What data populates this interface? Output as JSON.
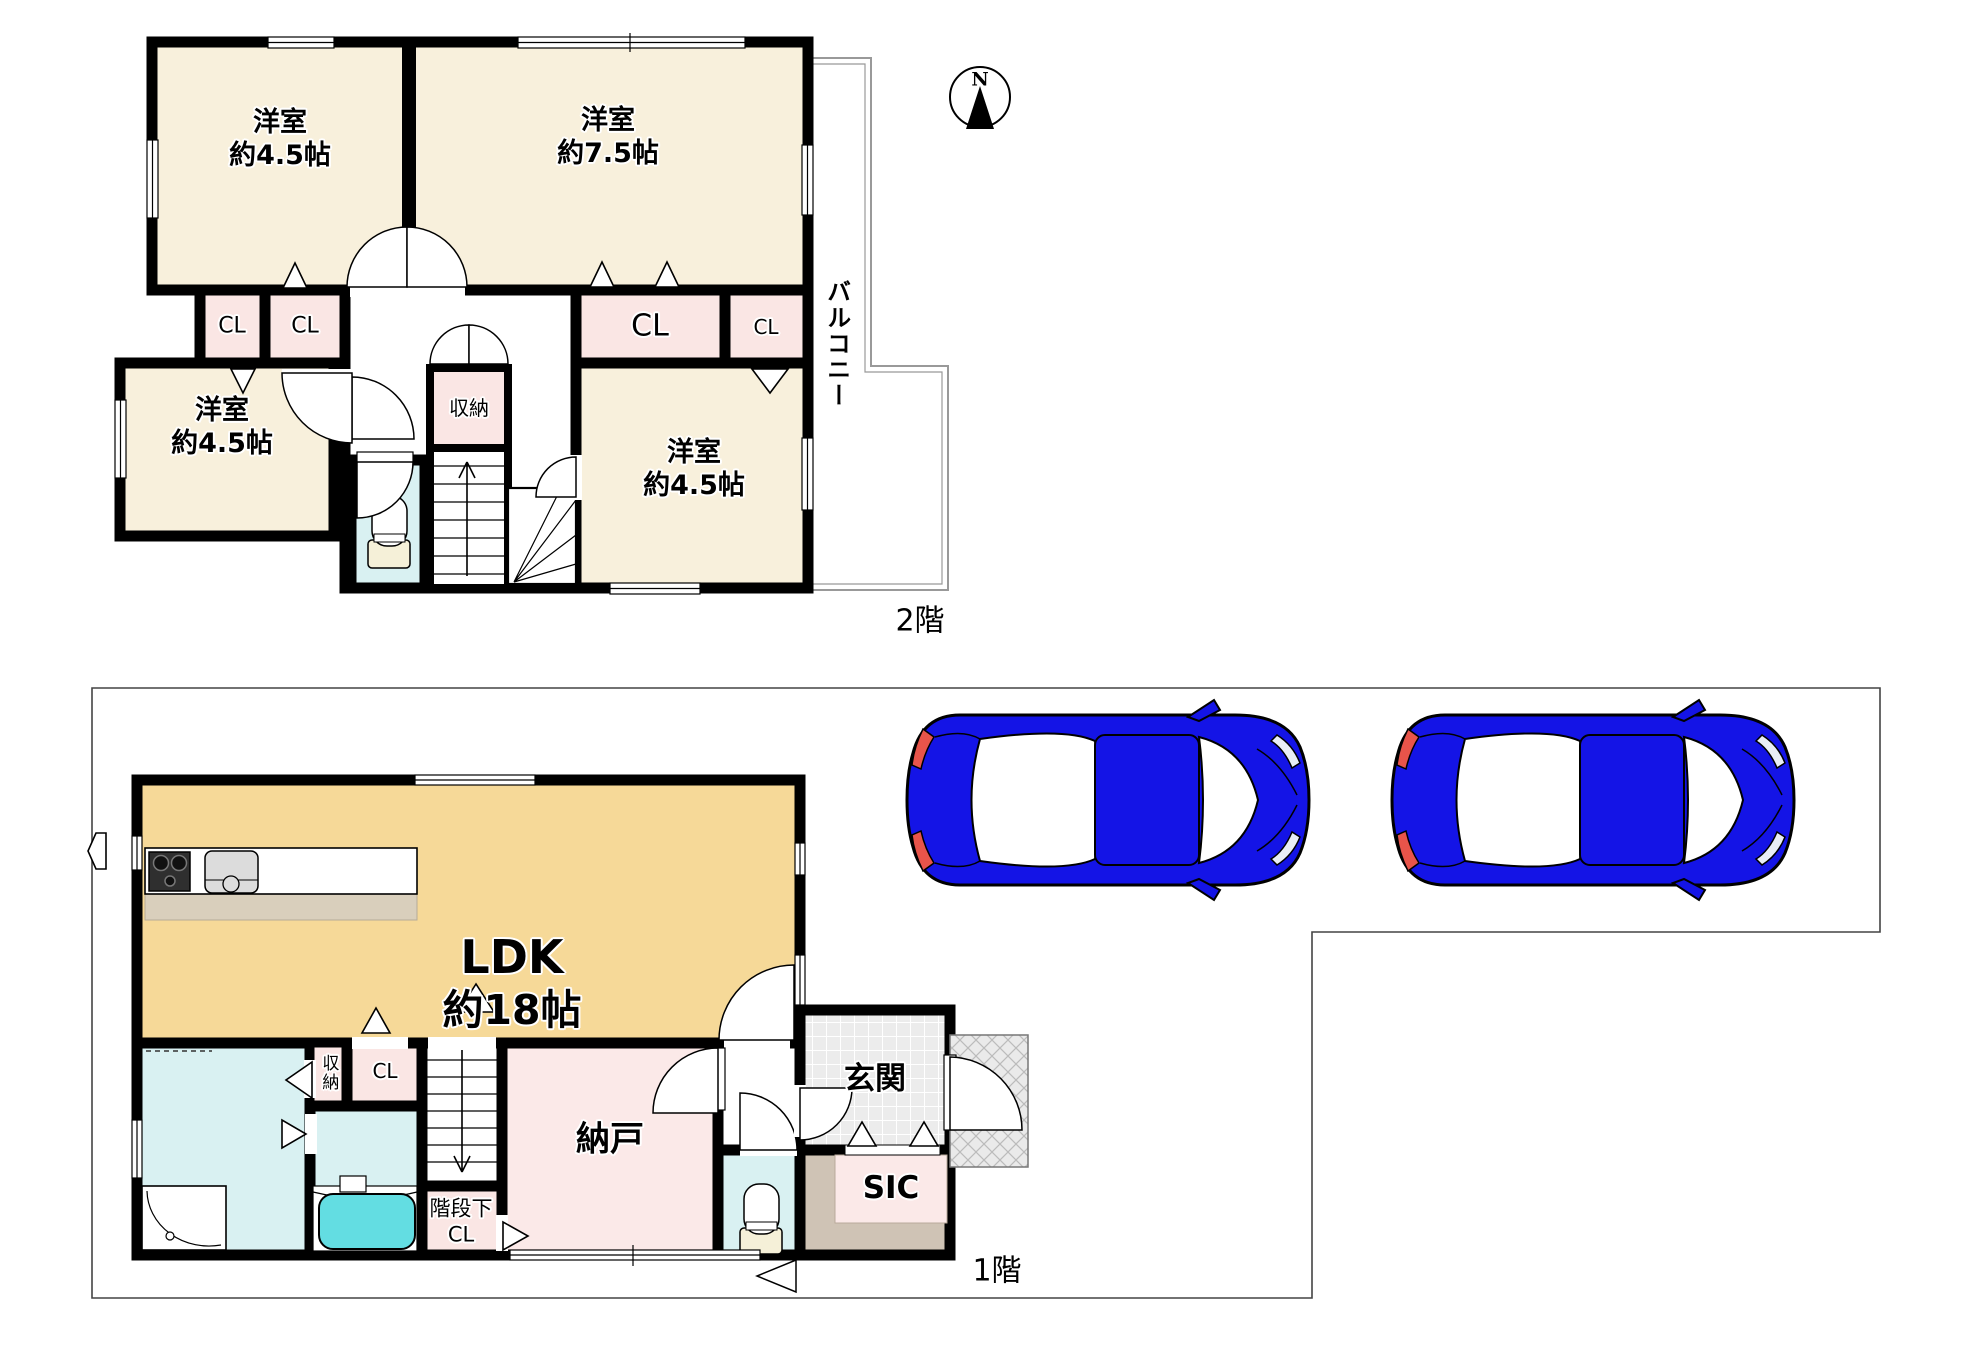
{
  "floor2": {
    "label": "2階",
    "compass_n": "N",
    "rooms": {
      "room_tl": {
        "name": "洋室",
        "size": "約4.5帖"
      },
      "room_tr": {
        "name": "洋室",
        "size": "約7.5帖"
      },
      "room_bl": {
        "name": "洋室",
        "size": "約4.5帖"
      },
      "room_br": {
        "name": "洋室",
        "size": "約4.5帖"
      },
      "cl_a": "CL",
      "cl_b": "CL",
      "cl_big": "CL",
      "cl_small": "CL",
      "shuno": "収納",
      "balcony": "バルコニー"
    }
  },
  "floor1": {
    "label": "1階",
    "rooms": {
      "ldk": {
        "name": "LDK",
        "size": "約18帖"
      },
      "nando": "納戸",
      "genkan": "玄関",
      "sic": "SIC",
      "kaidan_cl_line1": "階段下",
      "kaidan_cl_line2": "CL",
      "shuno": "収納",
      "cl": "CL"
    }
  },
  "colors": {
    "room_cream": "#f8f0dc",
    "ldk_yellow": "#f6d998",
    "closet_pink": "#fae6e4",
    "nando_pink": "#fbe9e8",
    "wet_cyan": "#d9f1f2",
    "bathtub_cyan": "#63dde2",
    "sic_tan": "#cfc3b5",
    "genkan_tile": "#ececec",
    "car_blue": "#1414e6",
    "tail_red": "#e8544a",
    "wall_black": "#000000"
  }
}
